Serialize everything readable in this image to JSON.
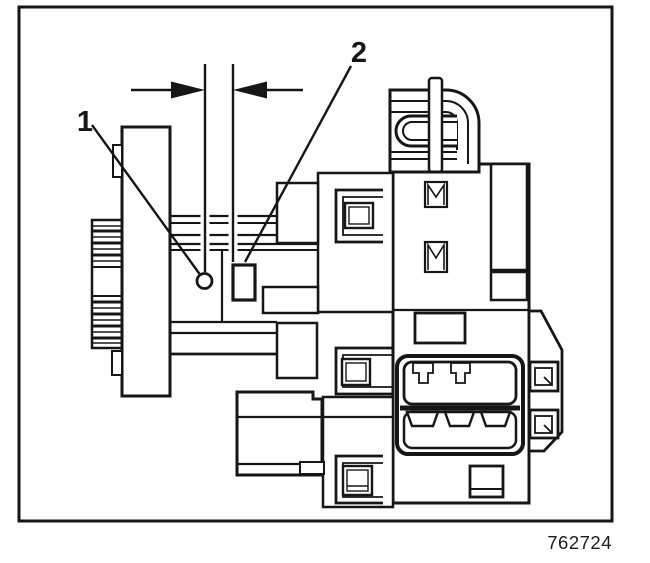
{
  "figure": {
    "callouts": [
      {
        "label": "1"
      },
      {
        "label": "2"
      }
    ],
    "figure_number": "762724",
    "colors": {
      "ink": "#161616",
      "paper": "#ffffff"
    }
  }
}
